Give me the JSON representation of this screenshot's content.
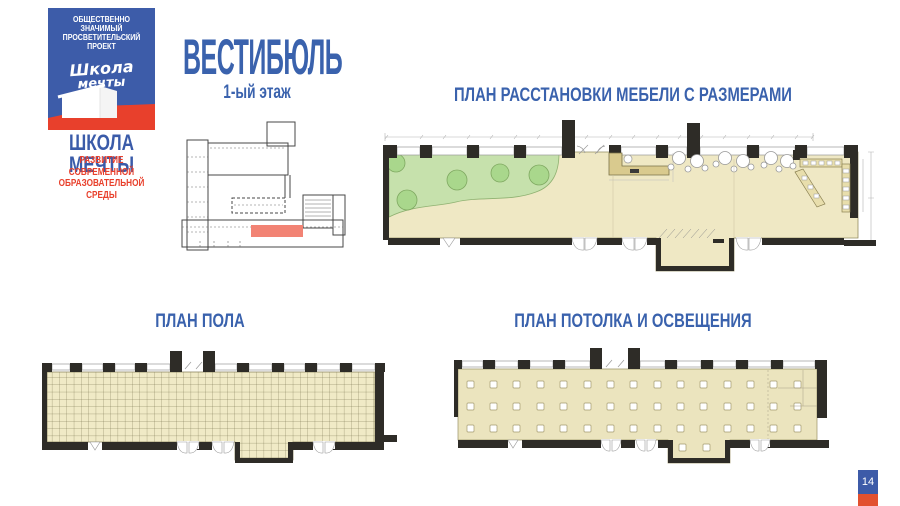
{
  "logo": {
    "project_type_line1": "ОБЩЕСТВЕННО ЗНАЧИМЫЙ",
    "project_type_line2": "ПРОСВЕТИТЕЛЬСКИЙ ПРОЕКТ",
    "script_word1": "Школа",
    "script_word2": "мечты",
    "brand_name": "ШКОЛА МЕЧТЫ",
    "tagline_line1": "РАЗВИТИЕ СОВРЕМЕННОЙ",
    "tagline_line2": "ОБРАЗОВАТЕЛЬНОЙ СРЕДЫ"
  },
  "header": {
    "title": "ВЕСТИБЮЛЬ",
    "floor_label": "1-ый этаж"
  },
  "plans": {
    "furniture": {
      "title": "ПЛАН РАССТАНОВКИ МЕБЕЛИ С РАЗМЕРАМИ"
    },
    "floor": {
      "title": "ПЛАН ПОЛА"
    },
    "ceiling": {
      "title": "ПЛАН ПОТОЛКА И ОСВЕЩЕНИЯ"
    }
  },
  "page": {
    "number": "14"
  },
  "colors": {
    "brand_blue": "#3D5CA9",
    "title_blue": "#3A62AD",
    "brand_red": "#E8402C",
    "badge_red": "#E2512F",
    "plan_floor_beige": "#EFE8C4",
    "plan_green_zone": "#C6E1AC",
    "tree_green": "#A9D78C",
    "wall_dark": "#2E2C27",
    "desk_tan": "#D9CA8E",
    "highlight_red": "#F28374"
  }
}
